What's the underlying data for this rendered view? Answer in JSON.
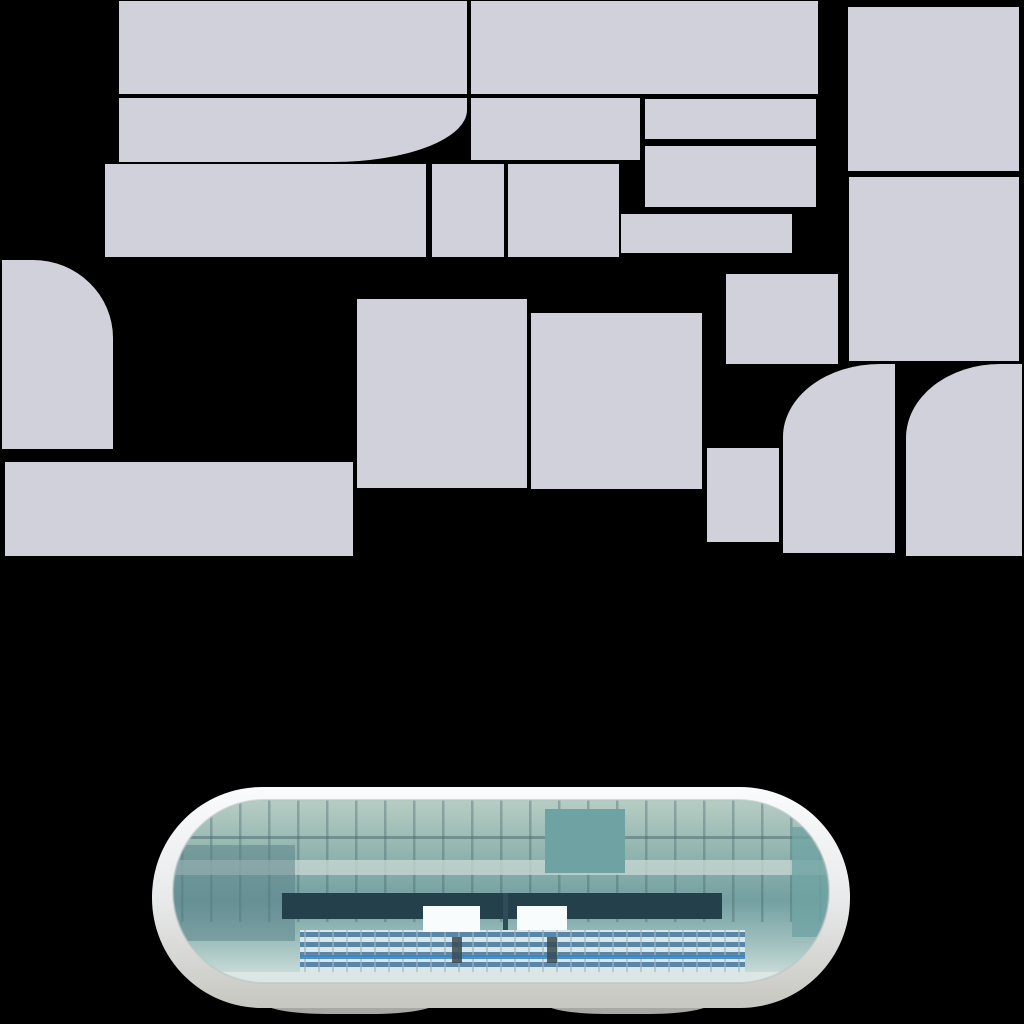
{
  "canvas": {
    "width": 1024,
    "height": 1024,
    "background": "#000000"
  },
  "palette": {
    "block_fill": "#d1d1db",
    "rim_top": "#fafbfc",
    "rim_mid": "#e9eaeb",
    "rim_bottom": "#c7c7c1",
    "rim_edge": "#b8c4c4",
    "shadow": "#a8a8a4",
    "glass_top": "#b7cdc4",
    "glass_upper": "#8fb4ae",
    "glass_mid": "#74a0a2",
    "glass_lower": "#9fc0bd",
    "glass_bottom": "#d5e4e2",
    "mullion": "#47666b",
    "panel_teal": "#6fa2a3",
    "left_shade": "#587f88",
    "light_band": "#c9d8d4",
    "dark_band": "#24404a",
    "divider": "#2e4d58",
    "scoreboard": "#f8fcfc",
    "seat_light": "#d9e7e9",
    "seat_blue": "#5a86a8",
    "seat_post": "#9fb6c0",
    "rail_blue": "#3f86c2",
    "figure": "#3a4b52",
    "floor": "#dce6e4"
  },
  "sprite_sheet": {
    "blocks": [
      {
        "id": "block-top-left-wide",
        "x": 119,
        "y": 1,
        "w": 348,
        "h": 93
      },
      {
        "id": "block-top-mid-wide",
        "x": 471,
        "y": 1,
        "w": 347,
        "h": 93
      },
      {
        "id": "block-top-right-tall",
        "x": 848,
        "y": 7,
        "w": 171,
        "h": 164
      },
      {
        "id": "block-row2-curved",
        "x": 119,
        "y": 98,
        "w": 348,
        "h": 64,
        "corner": "bottom-right",
        "rx": 134,
        "ry": 52
      },
      {
        "id": "block-row2-mid",
        "x": 471,
        "y": 98,
        "w": 169,
        "h": 62
      },
      {
        "id": "block-row2-right-thin",
        "x": 645,
        "y": 99,
        "w": 171,
        "h": 40
      },
      {
        "id": "block-row2-right-low",
        "x": 645,
        "y": 146,
        "w": 171,
        "h": 61
      },
      {
        "id": "block-row3-wide",
        "x": 105,
        "y": 164,
        "w": 321,
        "h": 93
      },
      {
        "id": "block-row3-small-square",
        "x": 432,
        "y": 164,
        "w": 72,
        "h": 93
      },
      {
        "id": "block-row3-mid-square",
        "x": 508,
        "y": 164,
        "w": 111,
        "h": 93
      },
      {
        "id": "block-row3-right-thin",
        "x": 621,
        "y": 214,
        "w": 171,
        "h": 39
      },
      {
        "id": "block-right-big-square",
        "x": 849,
        "y": 177,
        "w": 170,
        "h": 184
      },
      {
        "id": "block-left-round-top",
        "x": 2,
        "y": 260,
        "w": 111,
        "h": 189,
        "corner": "top-right",
        "rx": 80,
        "ry": 78
      },
      {
        "id": "block-mid-small-rect",
        "x": 726,
        "y": 274,
        "w": 112,
        "h": 90
      },
      {
        "id": "block-center-tall-left",
        "x": 357,
        "y": 299,
        "w": 170,
        "h": 189
      },
      {
        "id": "block-center-tall-right",
        "x": 531,
        "y": 313,
        "w": 171,
        "h": 176
      },
      {
        "id": "block-lower-small-square",
        "x": 707,
        "y": 448,
        "w": 72,
        "h": 94
      },
      {
        "id": "block-bottom-left-wide",
        "x": 5,
        "y": 462,
        "w": 348,
        "h": 94
      },
      {
        "id": "block-round-corner-left",
        "x": 783,
        "y": 364,
        "w": 112,
        "h": 189,
        "corner": "top-left",
        "rx": 97,
        "ry": 73
      },
      {
        "id": "block-round-corner-right",
        "x": 906,
        "y": 364,
        "w": 116,
        "h": 192,
        "corner": "top-left",
        "rx": 94,
        "ry": 74
      }
    ]
  },
  "stadium": {
    "x": 152,
    "y": 787,
    "w": 698,
    "h": 221,
    "shadows": [
      {
        "x": 265,
        "y": 990,
        "w": 170,
        "h": 24
      },
      {
        "x": 545,
        "y": 990,
        "w": 165,
        "h": 24
      },
      {
        "x": 700,
        "y": 984,
        "w": 62,
        "h": 20
      }
    ]
  }
}
